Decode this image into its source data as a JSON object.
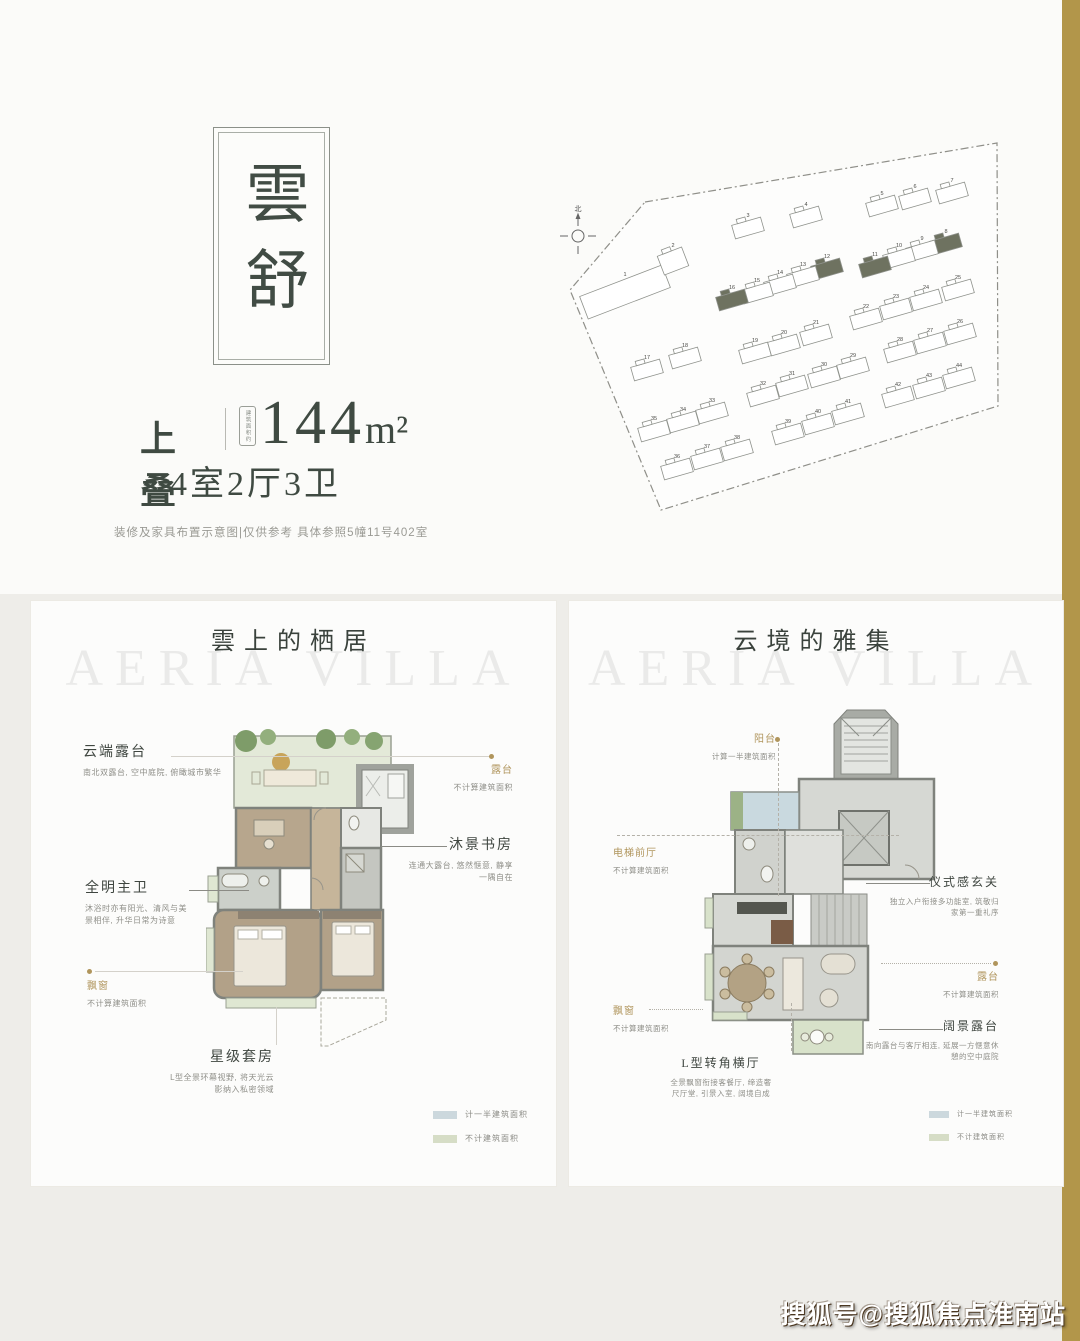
{
  "page": {
    "stripe_color": "#b2964a",
    "footer_watermark": "搜狐号@搜狐焦点淮南站"
  },
  "header": {
    "name_vertical": "雲舒",
    "type_label": "上叠",
    "area_note_vertical": "建筑面积约",
    "area_value": "144",
    "area_unit": "m²",
    "rooms_label": "4室2厅3卫",
    "disclaimer": "装修及家具布置示意图|仅供参考 具体参照5幢11号402室"
  },
  "siteplan": {
    "north_label": "北",
    "highlight_color": "#6e7260",
    "buildings": [
      {
        "n": "1",
        "x": 80,
        "y": 146,
        "w": 88,
        "h": 24,
        "r": -21,
        "nobump": true
      },
      {
        "n": "2",
        "x": 128,
        "y": 117,
        "w": 26,
        "h": 20,
        "r": -21
      },
      {
        "n": "3",
        "x": 203,
        "y": 87
      },
      {
        "n": "4",
        "x": 261,
        "y": 76
      },
      {
        "n": "5",
        "x": 337,
        "y": 65
      },
      {
        "n": "6",
        "x": 370,
        "y": 58
      },
      {
        "n": "7",
        "x": 407,
        "y": 52
      },
      {
        "n": "8",
        "x": 401,
        "y": 103,
        "hl": true
      },
      {
        "n": "9",
        "x": 377,
        "y": 110
      },
      {
        "n": "10",
        "x": 354,
        "y": 117
      },
      {
        "n": "11",
        "x": 330,
        "y": 126,
        "hl": true
      },
      {
        "n": "12",
        "x": 282,
        "y": 128,
        "hl": true
      },
      {
        "n": "13",
        "x": 258,
        "y": 136
      },
      {
        "n": "14",
        "x": 235,
        "y": 144
      },
      {
        "n": "15",
        "x": 212,
        "y": 152
      },
      {
        "n": "16",
        "x": 187,
        "y": 159,
        "hl": true
      },
      {
        "n": "17",
        "x": 102,
        "y": 229
      },
      {
        "n": "18",
        "x": 140,
        "y": 217
      },
      {
        "n": "19",
        "x": 210,
        "y": 212
      },
      {
        "n": "20",
        "x": 239,
        "y": 204
      },
      {
        "n": "21",
        "x": 271,
        "y": 194
      },
      {
        "n": "22",
        "x": 321,
        "y": 178
      },
      {
        "n": "23",
        "x": 351,
        "y": 168
      },
      {
        "n": "24",
        "x": 381,
        "y": 159
      },
      {
        "n": "25",
        "x": 413,
        "y": 149
      },
      {
        "n": "26",
        "x": 415,
        "y": 193
      },
      {
        "n": "27",
        "x": 385,
        "y": 202
      },
      {
        "n": "28",
        "x": 355,
        "y": 211
      },
      {
        "n": "29",
        "x": 308,
        "y": 227
      },
      {
        "n": "30",
        "x": 279,
        "y": 236
      },
      {
        "n": "31",
        "x": 247,
        "y": 245
      },
      {
        "n": "32",
        "x": 218,
        "y": 255
      },
      {
        "n": "33",
        "x": 167,
        "y": 272
      },
      {
        "n": "34",
        "x": 138,
        "y": 281
      },
      {
        "n": "35",
        "x": 109,
        "y": 290
      },
      {
        "n": "36",
        "x": 132,
        "y": 328
      },
      {
        "n": "37",
        "x": 162,
        "y": 318
      },
      {
        "n": "38",
        "x": 192,
        "y": 309
      },
      {
        "n": "39",
        "x": 243,
        "y": 293
      },
      {
        "n": "40",
        "x": 273,
        "y": 283
      },
      {
        "n": "41",
        "x": 303,
        "y": 273
      },
      {
        "n": "42",
        "x": 353,
        "y": 256
      },
      {
        "n": "43",
        "x": 384,
        "y": 247
      },
      {
        "n": "44",
        "x": 414,
        "y": 237
      }
    ]
  },
  "left_panel": {
    "title": "雲上的栖居",
    "watermark": "AERIA VILLA",
    "ann_cloud_terrace": {
      "title": "云端露台",
      "desc": "南北双露台, 空中庭院, 俯瞰城市繁华"
    },
    "ann_terrace": {
      "title": "露台",
      "desc": "不计算建筑面积"
    },
    "ann_study": {
      "title": "沐景书房",
      "desc1": "连通大露台, 悠然惬意, 静享",
      "desc2": "一隅自在"
    },
    "ann_master_bath": {
      "title": "全明主卫",
      "desc1": "沐浴时亦有阳光、清风与美",
      "desc2": "景相伴, 升华日常为诗意"
    },
    "ann_bay": {
      "title": "飘窗",
      "desc": "不计算建筑面积"
    },
    "ann_suite": {
      "title": "星级套房",
      "desc1": "L型全景环幕视野, 将天光云",
      "desc2": "影纳入私密领域"
    },
    "legend": [
      {
        "label": "计一半建筑面积",
        "color": "#ccd8dd"
      },
      {
        "label": "不计建筑面积",
        "color": "#d6ddc6"
      }
    ]
  },
  "right_panel": {
    "title": "云境的雅集",
    "watermark": "AERIA VILLA",
    "ann_balcony": {
      "title": "阳台",
      "desc": "计算一半建筑面积"
    },
    "ann_elevator": {
      "title": "电梯前厅",
      "desc": "不计算建筑面积"
    },
    "ann_foyer": {
      "title": "仪式感玄关",
      "desc1": "独立入户衔接多功能室, 筑敬归",
      "desc2": "家第一重礼序"
    },
    "ann_terrace": {
      "title": "露台",
      "desc": "不计算建筑面积"
    },
    "ann_bay": {
      "title": "飘窗",
      "desc": "不计算建筑面积"
    },
    "ann_view_terrace": {
      "title": "阔景露台",
      "desc1": "南向露台与客厅相连, 延展一方惬意休",
      "desc2": "憩的空中庭院"
    },
    "ann_corner_hall": {
      "title": "L型转角横厅",
      "desc1": "全景飘窗衔接客餐厅, 缔造奢",
      "desc2": "尺厅堂, 引景入室, 阔境自成"
    },
    "legend": [
      {
        "label": "计一半建筑面积",
        "color": "#ccd8dd"
      },
      {
        "label": "不计建筑面积",
        "color": "#d6ddc6"
      }
    ]
  }
}
